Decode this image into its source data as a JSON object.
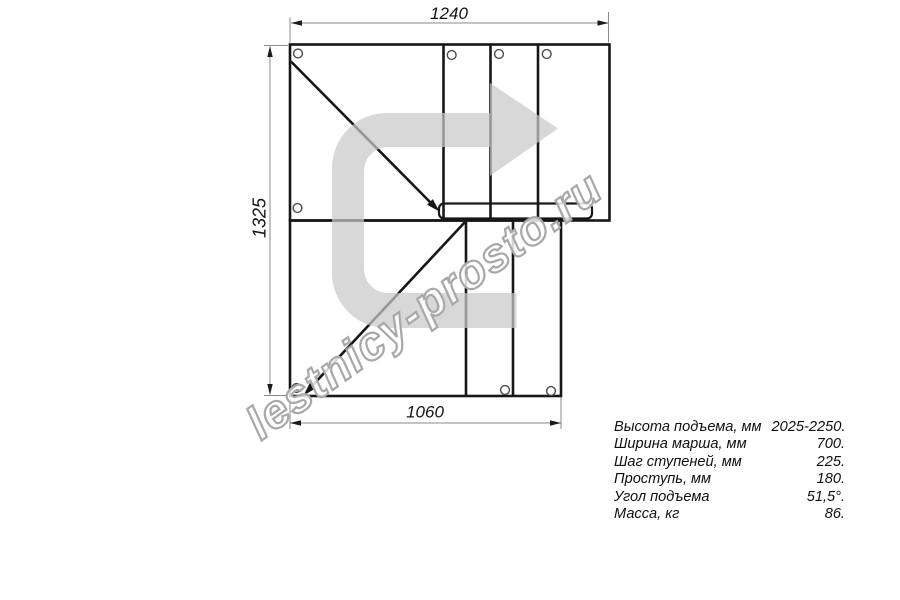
{
  "drawing": {
    "dimensions": {
      "top": "1240",
      "left": "1325",
      "bottom": "1060"
    }
  },
  "watermark": {
    "text": "lestnicy-prosto.ru",
    "arrow_color": "#c9c9c9",
    "outline_color": "#a8a8a8"
  },
  "specs": {
    "rows": [
      {
        "label": "Высота подъема, мм",
        "value": "2025-2250."
      },
      {
        "label": "Ширина марша, мм",
        "value": "700."
      },
      {
        "label": "Шаг ступеней, мм",
        "value": "225."
      },
      {
        "label": "Проступь, мм",
        "value": "180."
      },
      {
        "label": "Угол подъема",
        "value": "51,5°."
      },
      {
        "label": "Масса, кг",
        "value": "86."
      }
    ]
  }
}
